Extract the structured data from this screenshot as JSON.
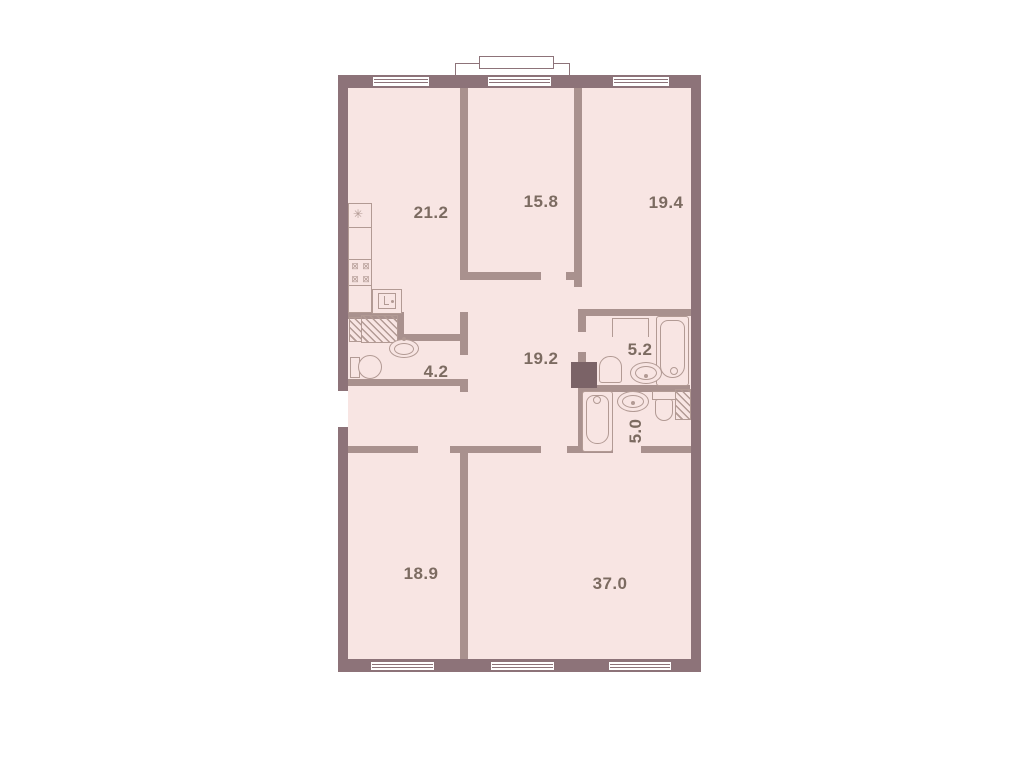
{
  "plan": {
    "type": "apartment-floor-plan",
    "rooms": [
      {
        "id": "kitchen-living",
        "area": "21.2"
      },
      {
        "id": "bedroom-middle",
        "area": "15.8"
      },
      {
        "id": "bedroom-right",
        "area": "19.4"
      },
      {
        "id": "bathroom-left",
        "area": "4.2"
      },
      {
        "id": "hallway",
        "area": "19.2"
      },
      {
        "id": "bathroom-upper-right",
        "area": "5.2"
      },
      {
        "id": "bathroom-lower-right",
        "area": "5.0"
      },
      {
        "id": "bedroom-bottom-left",
        "area": "18.9"
      },
      {
        "id": "living-room-bottom-right",
        "area": "37.0"
      }
    ],
    "glyphs": {
      "extractor_symbol": "✳",
      "burner_symbol": "⊠"
    },
    "colors": {
      "room_fill": "#f8e5e3",
      "exterior_wall": "#8d7379",
      "interior_wall": "#a9918e",
      "fixture_line": "#b29a94",
      "shaft_fill": "#7b6367",
      "label_text": "#7c6b61",
      "background": "#ffffff"
    },
    "fixtures": [
      "kitchen-counter",
      "stove-burners",
      "kitchen-sink",
      "washing-machine",
      "sink",
      "toilet",
      "bathtub",
      "towel-rail",
      "ventilation-shaft",
      "balcony",
      "windows"
    ]
  }
}
